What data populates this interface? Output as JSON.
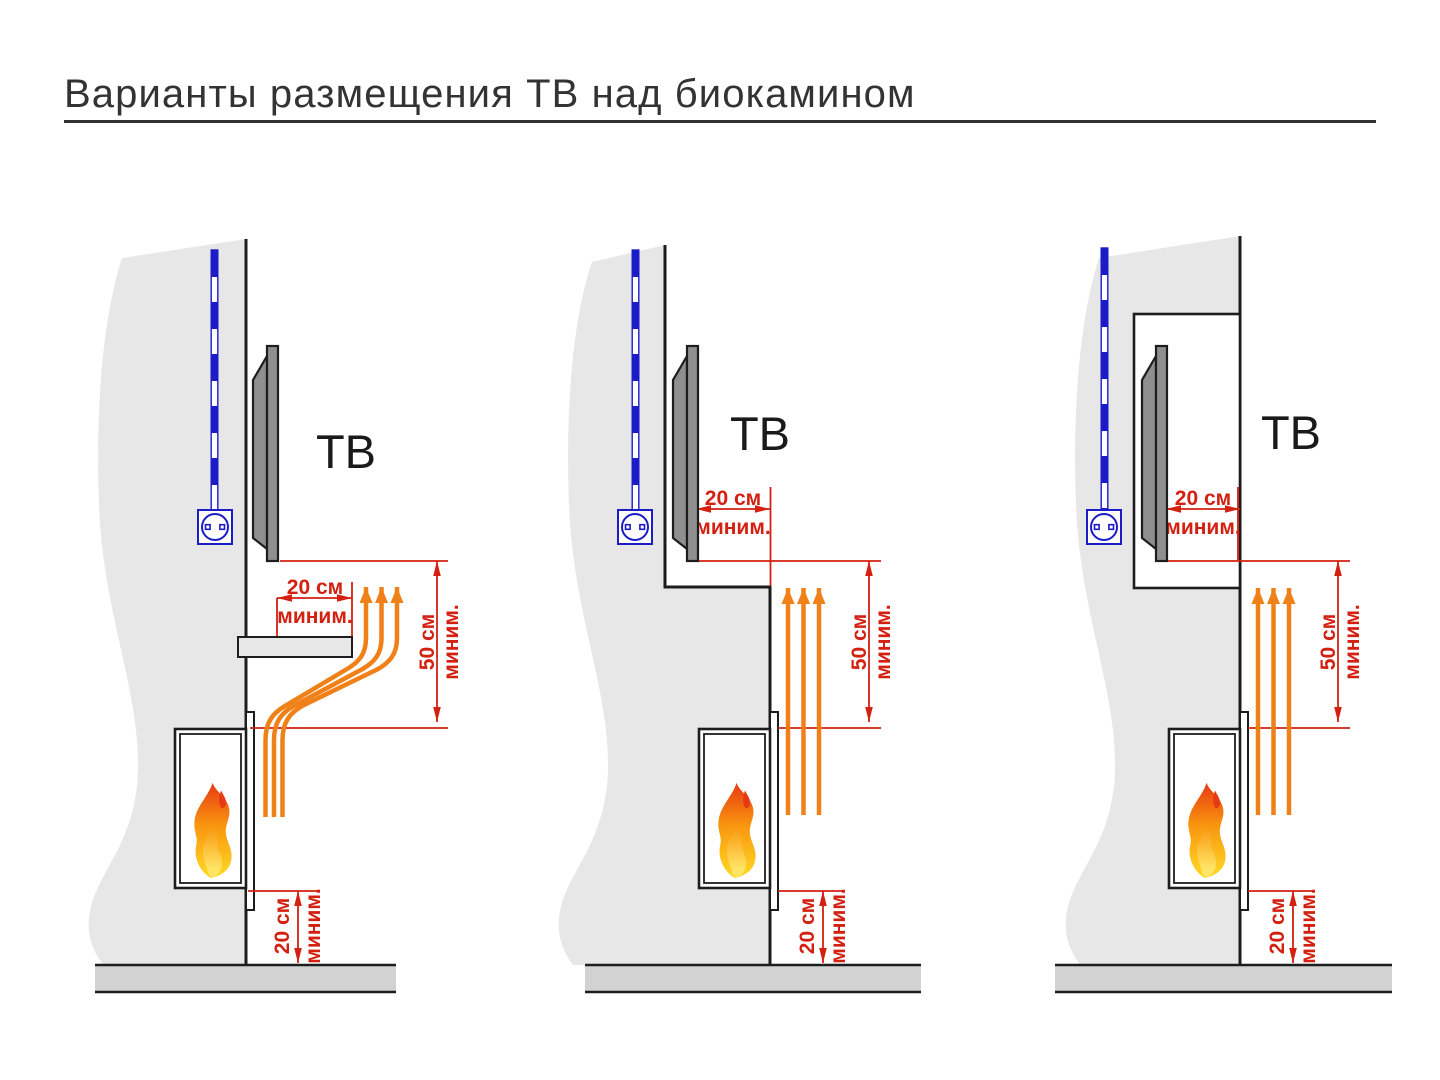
{
  "title": {
    "text": "Варианты размещения ТВ над биокамином"
  },
  "colors": {
    "background": "#ffffff",
    "title_text": "#333333",
    "diagram_line": "#1d1d1d",
    "wall_fill": "#e7e7e7",
    "floor_fill": "#d2d2d2",
    "tv_fill": "#8f8f8f",
    "label_text": "#1a1a1a",
    "dimension_red": "#d32011",
    "flow_orange": "#f08119",
    "cable_blue": "#1b1bc8",
    "flame_top": "#e73a12",
    "flame_mid": "#f9960f",
    "flame_bottom": "#ffd422",
    "flame_inner": "#ffe566"
  },
  "diagrams": [
    {
      "tv_label": "ТВ",
      "top_clearance": {
        "value": "20 см",
        "qualifier": "миним."
      },
      "vertical_clearance": {
        "value": "50 см",
        "qualifier": "миним."
      },
      "floor_clearance": {
        "value": "20 см",
        "qualifier": "миним."
      }
    },
    {
      "tv_label": "ТВ",
      "top_clearance": {
        "value": "20 см",
        "qualifier": "миним."
      },
      "vertical_clearance": {
        "value": "50 см",
        "qualifier": "миним."
      },
      "floor_clearance": {
        "value": "20 см",
        "qualifier": "миним."
      }
    },
    {
      "tv_label": "ТВ",
      "top_clearance": {
        "value": "20 см",
        "qualifier": "миним."
      },
      "vertical_clearance": {
        "value": "50 см",
        "qualifier": "миним."
      },
      "floor_clearance": {
        "value": "20 см",
        "qualifier": "миним."
      }
    }
  ]
}
